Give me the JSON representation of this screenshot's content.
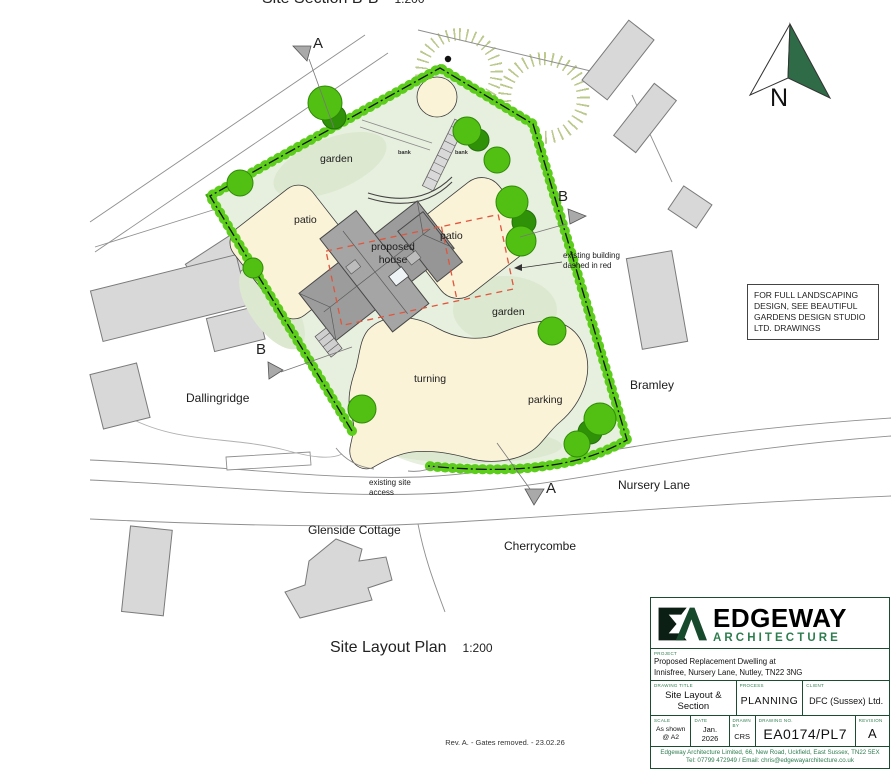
{
  "titles": {
    "top_title": "Site Section B-B",
    "top_scale": "1:200",
    "plan_title": "Site Layout Plan",
    "plan_scale": "1:200",
    "rev_note": "Rev. A. - Gates removed. - 23.02.26"
  },
  "north": {
    "label": "N",
    "icon": "north-arrow",
    "fill_color": "#2e6b46"
  },
  "note_box": {
    "text": "FOR FULL LANDSCAPING DESIGN, SEE BEAUTIFUL GARDENS DESIGN STUDIO LTD. DRAWINGS"
  },
  "plan_labels": {
    "garden_top": "garden",
    "garden_right": "garden",
    "patio_left": "patio",
    "patio_right": "patio",
    "proposed_house": "proposed house",
    "bank_left": "bank",
    "bank_right": "bank",
    "turning": "turning",
    "parking": "parking",
    "existing_building_note": "existing building dashed in red",
    "site_access_note": "existing site access",
    "neighbour_left": "Dallingridge",
    "neighbour_right": "Bramley",
    "road_name": "Nursery Lane",
    "neighbour_bottom_left": "Glenside Cottage",
    "neighbour_bottom_right": "Cherrycombe"
  },
  "section_markers": {
    "a_top": "A",
    "a_bottom": "A",
    "b_left": "B",
    "b_right": "B"
  },
  "colors": {
    "hedge_green": "#3aa50c",
    "tree_green": "#52c013",
    "lawn_green": "#e7efde",
    "paving_cream": "#faf3d8",
    "house_grey": "#9c9c9c",
    "existing_red": "#e0563c",
    "brand_green": "#2e7d4f"
  },
  "title_block": {
    "logo_icon": "ea-monogram",
    "brand_name": "EDGEWAY",
    "brand_sub": "ARCHITECTURE",
    "project_label": "PROJECT",
    "project_line1": "Proposed Replacement Dwelling at",
    "project_line2": "Innisfree, Nursery Lane, Nutley, TN22 3NG",
    "drawing_title_label": "DRAWING TITLE",
    "drawing_title": "Site Layout & Section",
    "process_label": "PROCESS",
    "process": "PLANNING",
    "client_label": "CLIENT",
    "client": "DFC (Sussex) Ltd.",
    "scale_label": "SCALE",
    "scale": "As shown @ A2",
    "date_label": "DATE",
    "date": "Jan. 2026",
    "drawn_label": "DRAWN BY",
    "drawn": "CRS",
    "drawing_no_label": "DRAWING NO.",
    "drawing_no": "EA0174/PL7",
    "revision_label": "REVISION",
    "revision": "A",
    "footer_line1": "Edgeway Architecture Limited, 66, New Road, Uckfield, East Sussex, TN22 5EX",
    "footer_line2": "Tel: 07799 472949  /  Email: chris@edgewayarchitecture.co.uk"
  }
}
